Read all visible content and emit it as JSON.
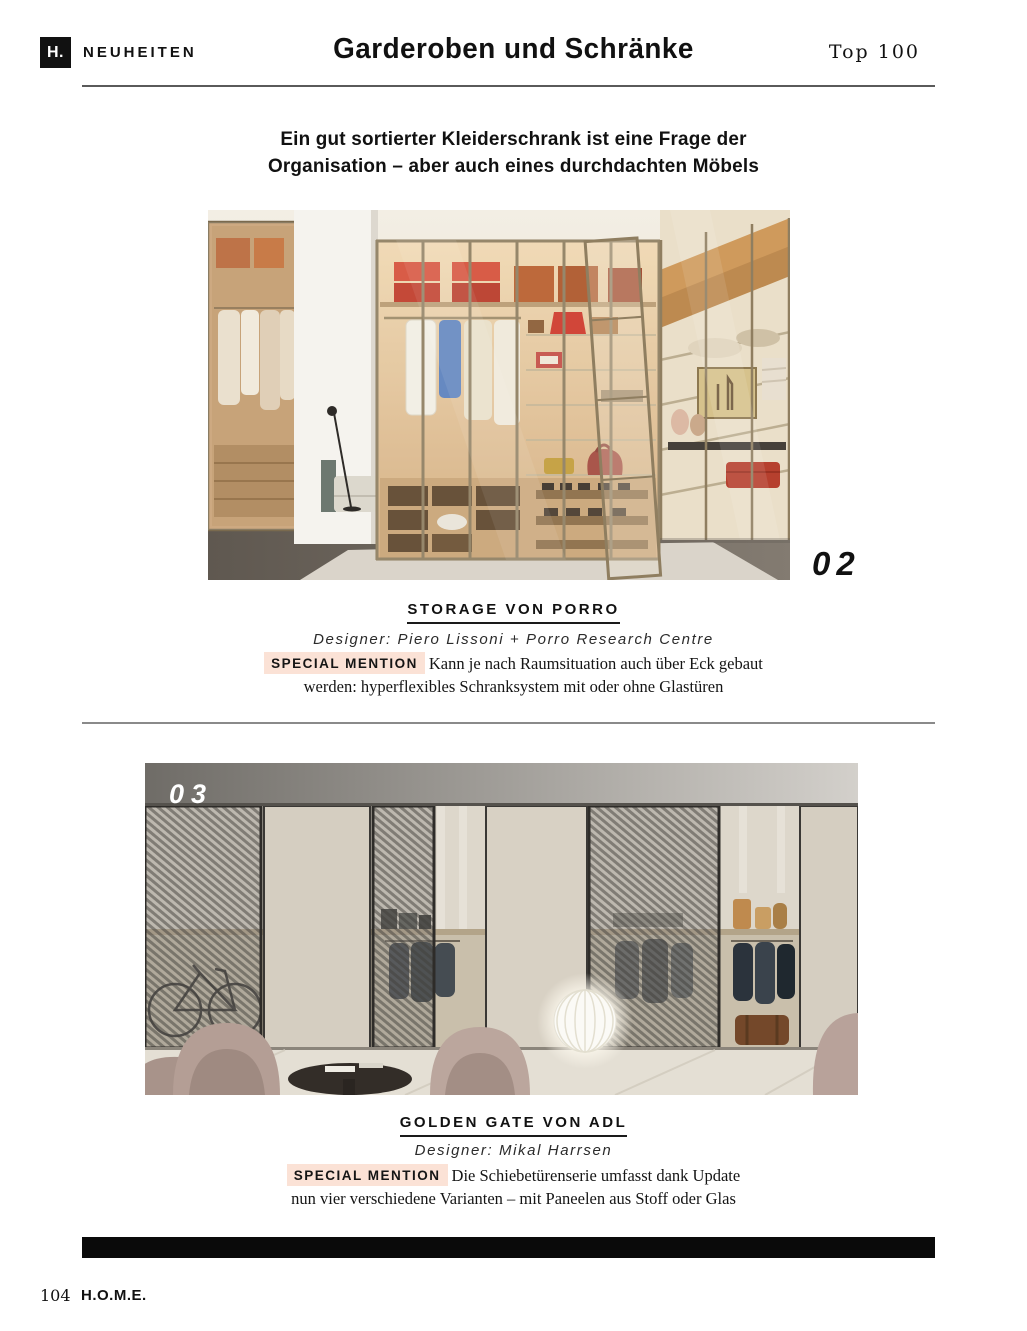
{
  "header": {
    "logo": "H.",
    "section": "NEUHEITEN",
    "title": "Garderoben und Schränke",
    "issue": "Top 100"
  },
  "intro": {
    "line1": "Ein gut sortierter Kleiderschrank ist eine Frage der",
    "line2": "Organisation – aber auch eines durchdachten Möbels"
  },
  "items": [
    {
      "number": "02",
      "title": "STORAGE VON PORRO",
      "designer": "Designer: Piero Lissoni + Porro Research Centre",
      "badge": "SPECIAL MENTION",
      "desc1": "Kann je nach Raumsituation auch über Eck gebaut",
      "desc2": "werden: hyperflexibles Schranksystem mit oder ohne Glastüren",
      "photo_alt": "walk-in-closet-with-glass-doors"
    },
    {
      "number": "03",
      "title": "GOLDEN GATE VON ADL",
      "designer": "Designer: Mikal Harrsen",
      "badge": "SPECIAL MENTION",
      "desc1": "Die Schiebetürenserie umfasst dank Update",
      "desc2": "nun vier verschiedene Varianten – mit Paneelen aus Stoff oder Glas",
      "photo_alt": "sliding-door-wardrobe-with-mesh-panels"
    }
  ],
  "footer": {
    "page_number": "104",
    "magazine": "H.O.M.E."
  },
  "colors": {
    "badge_bg": "#fbe2d6",
    "text": "#111111",
    "bar": "#0a0a0a"
  }
}
